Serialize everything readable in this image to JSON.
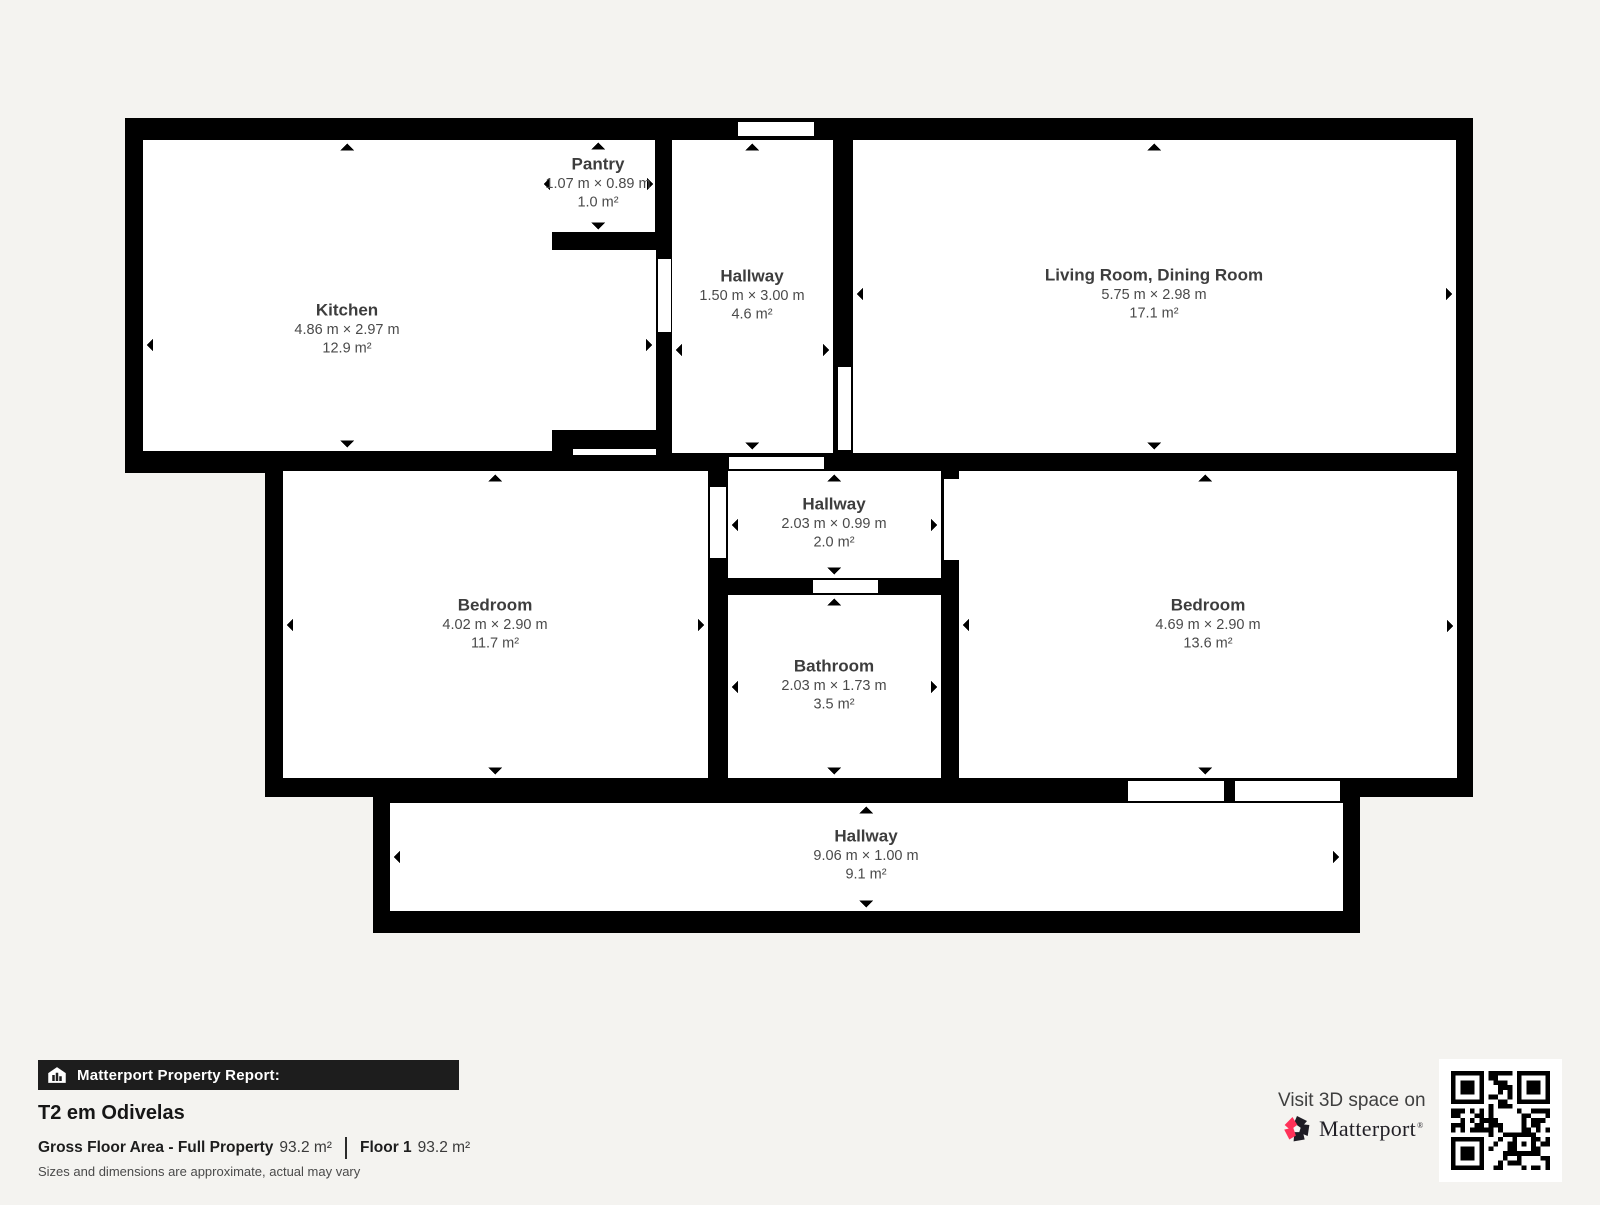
{
  "plan": {
    "rooms": [
      {
        "id": "kitchen",
        "name": "Kitchen",
        "dims": "4.86 m × 2.97 m",
        "area": "12.9 m²"
      },
      {
        "id": "pantry",
        "name": "Pantry",
        "dims": "1.07 m × 0.89 m",
        "area": "1.0 m²"
      },
      {
        "id": "hallway-top",
        "name": "Hallway",
        "dims": "1.50 m × 3.00 m",
        "area": "4.6 m²"
      },
      {
        "id": "living-dining",
        "name": "Living Room, Dining Room",
        "dims": "5.75 m × 2.98 m",
        "area": "17.1 m²"
      },
      {
        "id": "bedroom-left",
        "name": "Bedroom",
        "dims": "4.02 m × 2.90 m",
        "area": "11.7 m²"
      },
      {
        "id": "hallway-middle",
        "name": "Hallway",
        "dims": "2.03 m × 0.99 m",
        "area": "2.0 m²"
      },
      {
        "id": "bathroom",
        "name": "Bathroom",
        "dims": "2.03 m × 1.73 m",
        "area": "3.5 m²"
      },
      {
        "id": "bedroom-right",
        "name": "Bedroom",
        "dims": "4.69 m × 2.90 m",
        "area": "13.6 m²"
      },
      {
        "id": "hallway-bottom",
        "name": "Hallway",
        "dims": "9.06 m × 1.00 m",
        "area": "9.1 m²"
      }
    ]
  },
  "footer": {
    "report_label": "Matterport Property Report:",
    "property_title": "T2 em Odivelas",
    "gross_label": "Gross Floor Area - Full Property",
    "gross_value": "93.2 m²",
    "floor_label": "Floor 1",
    "floor_value": "93.2 m²",
    "disclaimer": "Sizes and dimensions are approximate, actual may vary",
    "visit_text": "Visit 3D space on",
    "brand": "Matterport",
    "brand_mark": "®"
  },
  "colors": {
    "wall": "#000000",
    "floor": "#ffffff",
    "background": "#f4f3f0",
    "accent_red": "#ff3158",
    "footer_bar": "#1d1d1d",
    "room_title_text": "#3d3d3d",
    "room_sub_text": "#4a4a4a"
  }
}
